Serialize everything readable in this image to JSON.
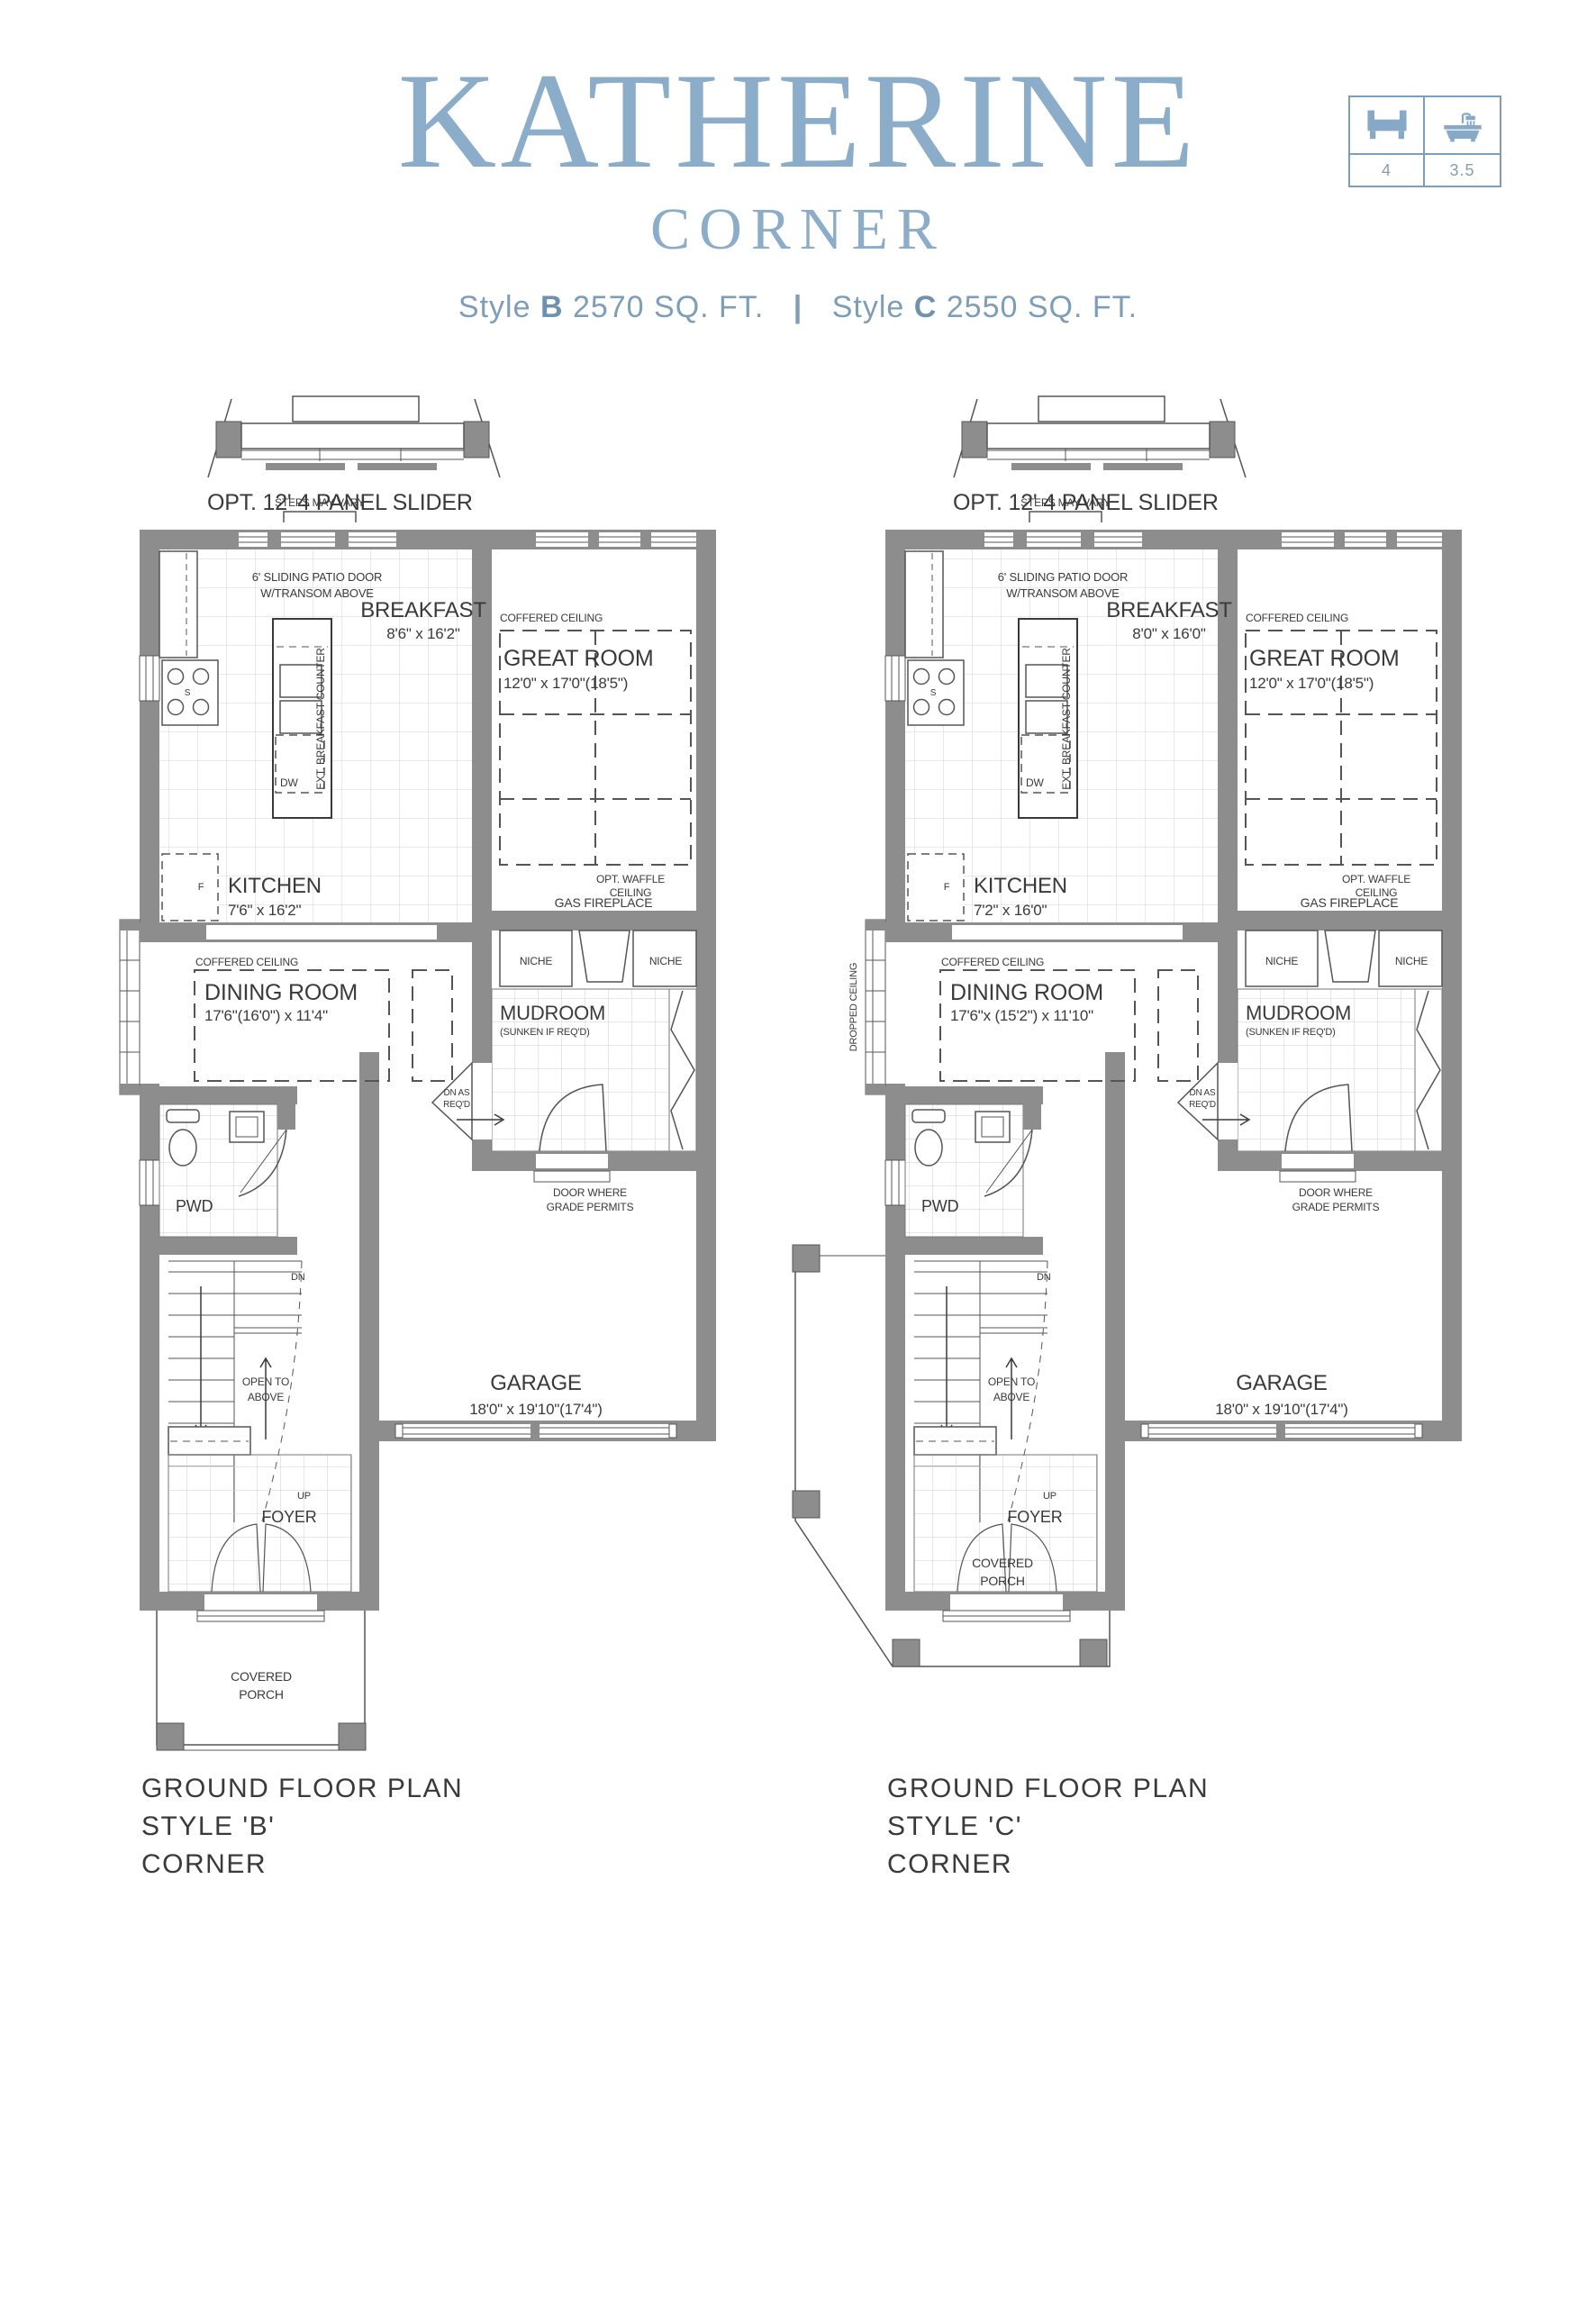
{
  "header": {
    "title": "KATHERINE",
    "subtitle": "CORNER",
    "style_b_prefix": "Style",
    "style_b_bold": "B",
    "style_b_rest": "2570 SQ. FT.",
    "separator": "|",
    "style_c_prefix": "Style",
    "style_c_bold": "C",
    "style_c_rest": "2550 SQ. FT.",
    "info_box": {
      "bedrooms": "4",
      "bathrooms": "3.5"
    }
  },
  "plan_b": {
    "slider_label": "OPT. 12' 4 PANEL SLIDER",
    "steps_label": "STEPS MAY VARY",
    "patio_door_line1": "6' SLIDING PATIO DOOR",
    "patio_door_line2": "W/TRANSOM ABOVE",
    "breakfast_name": "BREAKFAST",
    "breakfast_dims": "8'6\" x 16'2\"",
    "coffered_great": "COFFERED CEILING",
    "great_name": "GREAT ROOM",
    "great_dims": "12'0\" x 17'0\"(18'5\")",
    "kitchen_name": "KITCHEN",
    "kitchen_dims": "7'6\" x 16'2\"",
    "ext_counter": "EXT. BREAKFAST COUNTER",
    "dw": "DW",
    "s": "S",
    "f": "F",
    "opt_waffle_1": "OPT. WAFFLE",
    "opt_waffle_2": "CEILING",
    "gas_fireplace": "GAS FIREPLACE",
    "niche_left": "NICHE",
    "niche_right": "NICHE",
    "coffered_dining": "COFFERED CEILING",
    "dining_name": "DINING ROOM",
    "dining_dims": "17'6\"(16'0\") x 11'4\"",
    "mudroom_name": "MUDROOM",
    "mudroom_sub": "(SUNKEN IF REQ'D)",
    "dn_as_reqd_1": "DN AS",
    "dn_as_reqd_2": "REQ'D",
    "door_where_1": "DOOR WHERE",
    "door_where_2": "GRADE PERMITS",
    "pwd": "PWD",
    "dn": "DN",
    "up": "UP",
    "open_above_1": "OPEN TO",
    "open_above_2": "ABOVE",
    "garage_name": "GARAGE",
    "garage_dims": "18'0\" x 19'10\"(17'4\")",
    "foyer": "FOYER",
    "porch_1": "COVERED",
    "porch_2": "PORCH",
    "caption_1": "GROUND FLOOR PLAN",
    "caption_2": "STYLE 'B'",
    "caption_3": "CORNER"
  },
  "plan_c": {
    "slider_label": "OPT. 12' 4 PANEL SLIDER",
    "steps_label": "STEPS MAY VARY",
    "patio_door_line1": "6' SLIDING PATIO DOOR",
    "patio_door_line2": "W/TRANSOM ABOVE",
    "breakfast_name": "BREAKFAST",
    "breakfast_dims": "8'0\" x 16'0\"",
    "coffered_great": "COFFERED CEILING",
    "great_name": "GREAT ROOM",
    "great_dims": "12'0\" x 17'0\"(18'5\")",
    "kitchen_name": "KITCHEN",
    "kitchen_dims": "7'2\" x 16'0\"",
    "ext_counter": "EXT. BREAKFAST COUNTER",
    "dw": "DW",
    "s": "S",
    "f": "F",
    "opt_waffle_1": "OPT. WAFFLE",
    "opt_waffle_2": "CEILING",
    "gas_fireplace": "GAS FIREPLACE",
    "niche_left": "NICHE",
    "niche_right": "NICHE",
    "coffered_dining": "COFFERED CEILING",
    "dining_name": "DINING ROOM",
    "dining_dims": "17'6\"x (15'2\") x 11'10\"",
    "dropped_ceiling": "DROPPED CEILING",
    "mudroom_name": "MUDROOM",
    "mudroom_sub": "(SUNKEN IF REQ'D)",
    "dn_as_reqd_1": "DN AS",
    "dn_as_reqd_2": "REQ'D",
    "door_where_1": "DOOR WHERE",
    "door_where_2": "GRADE PERMITS",
    "pwd": "PWD",
    "dn": "DN",
    "up": "UP",
    "open_above_1": "OPEN TO",
    "open_above_2": "ABOVE",
    "garage_name": "GARAGE",
    "garage_dims": "18'0\" x 19'10\"(17'4\")",
    "foyer": "FOYER",
    "porch_1": "COVERED",
    "porch_2": "PORCH",
    "caption_1": "GROUND FLOOR PLAN",
    "caption_2": "STYLE 'C'",
    "caption_3": "CORNER"
  }
}
